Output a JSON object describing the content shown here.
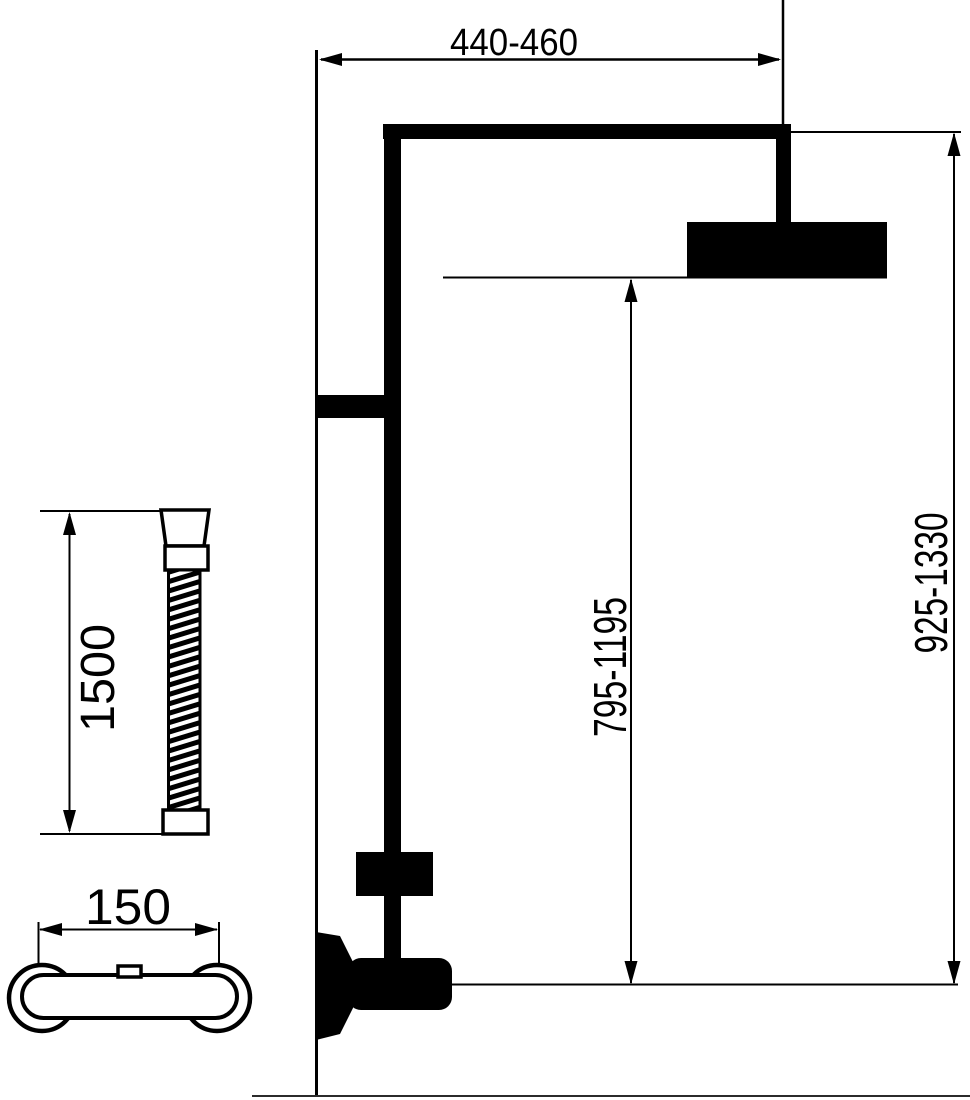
{
  "figure": {
    "background_color": "#ffffff",
    "line_color": "#000000",
    "labels": {
      "top_width": "440-460",
      "right_height": "925-1330",
      "mid_height": "795-1195",
      "hose_length": "1500",
      "mixer_width": "150"
    }
  }
}
